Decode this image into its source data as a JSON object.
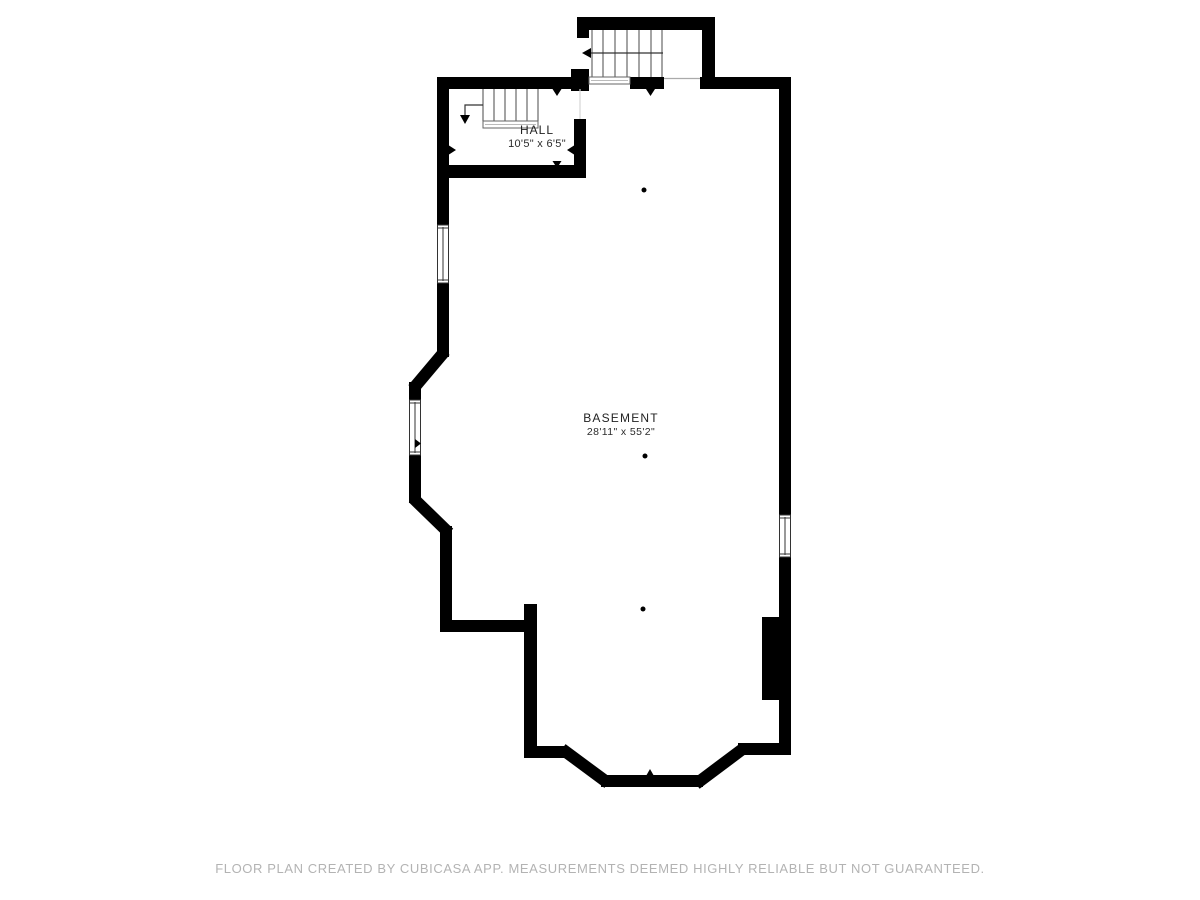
{
  "plan": {
    "type": "floor-plan",
    "floor": "basement"
  },
  "rooms": [
    {
      "name": "HALL",
      "dimensions": "10'5\" x 6'5\""
    },
    {
      "name": "BASEMENT",
      "dimensions": "28'11\" x 55'2\""
    }
  ],
  "footer": {
    "text": "FLOOR PLAN CREATED BY CUBICASA APP. MEASUREMENTS DEEMED HIGHLY RELIABLE BUT NOT GUARANTEED."
  },
  "colors": {
    "wall": "#000000",
    "stair_line": "#666666",
    "arrow_line": "#333333",
    "window_frame": "#333333",
    "footer_text": "#b3b3b3",
    "background": "#ffffff"
  }
}
